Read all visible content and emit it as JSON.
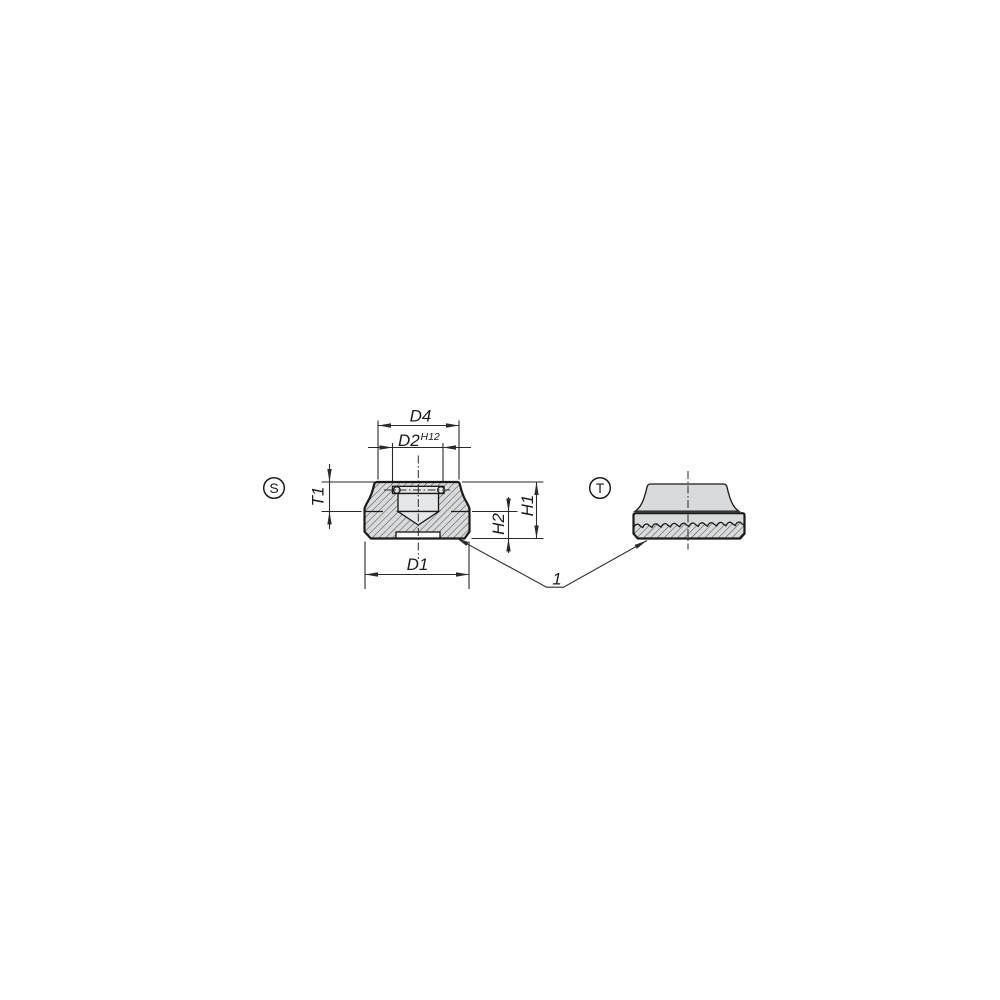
{
  "drawing": {
    "views": {
      "section_view": {
        "badge": "S"
      },
      "side_view": {
        "badge": "T"
      }
    },
    "dimensions": {
      "top_outer_diameter": {
        "label": "D4"
      },
      "bore_diameter": {
        "label": "D2",
        "tolerance": "H12"
      },
      "bore_depth": {
        "label": "T1"
      },
      "total_height": {
        "label": "H1"
      },
      "base_height": {
        "label": "H2"
      },
      "base_diameter": {
        "label": "D1"
      }
    },
    "callout": {
      "serrated_face": {
        "label": "1"
      }
    },
    "colors": {
      "background": "#ffffff",
      "line": "#1b1b1b",
      "thin_line": "#2a2a2a",
      "material_fill": "#d8dadb",
      "void_fill": "#e5e6e7",
      "recess_fill": "#fbfbfb",
      "hatch_line": "#454545"
    }
  }
}
